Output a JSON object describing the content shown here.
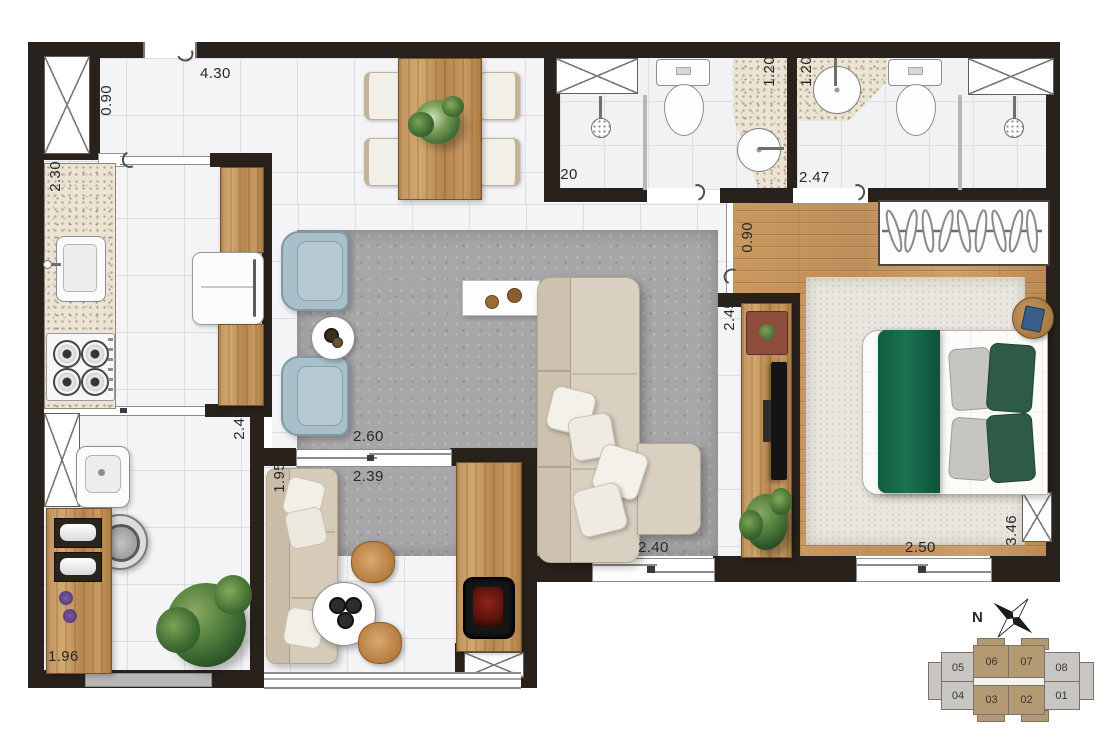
{
  "plan": {
    "dims": {
      "entry_length": "4.30",
      "entry_width": "0.90",
      "kitchen_counter": "2.30",
      "kitchen_passage": "2.47",
      "bath_social_width": "2.20",
      "bath_social_counter": "1.20",
      "bath_suite_counter": "1.20",
      "bath_suite_width": "2.47",
      "hall_width": "0.90",
      "tv_wall": "2.45",
      "balcony_opening": "2.60",
      "balcony_length": "2.39",
      "balcony_depth": "1.95",
      "living_door": "2.40",
      "bedroom_door": "2.50",
      "bedroom_length": "3.46",
      "service_length": "1.96"
    },
    "compass": {
      "north": "N"
    },
    "keyplan": {
      "top_row": [
        "05",
        "06",
        "07",
        "08"
      ],
      "bottom_row": [
        "04",
        "03",
        "02",
        "01"
      ],
      "highlighted": [
        "06",
        "07",
        "03",
        "02"
      ],
      "highlight_color": "#b49a72",
      "muted_color": "#c8c6c3"
    },
    "palette": {
      "wall": "#29221c",
      "wood_floor": "#c49467",
      "bed_green": "#15694a",
      "living_rug": "#a7a7aa",
      "tile": "#f4f4f6",
      "armchair_blue": "#a9bfc9"
    }
  }
}
